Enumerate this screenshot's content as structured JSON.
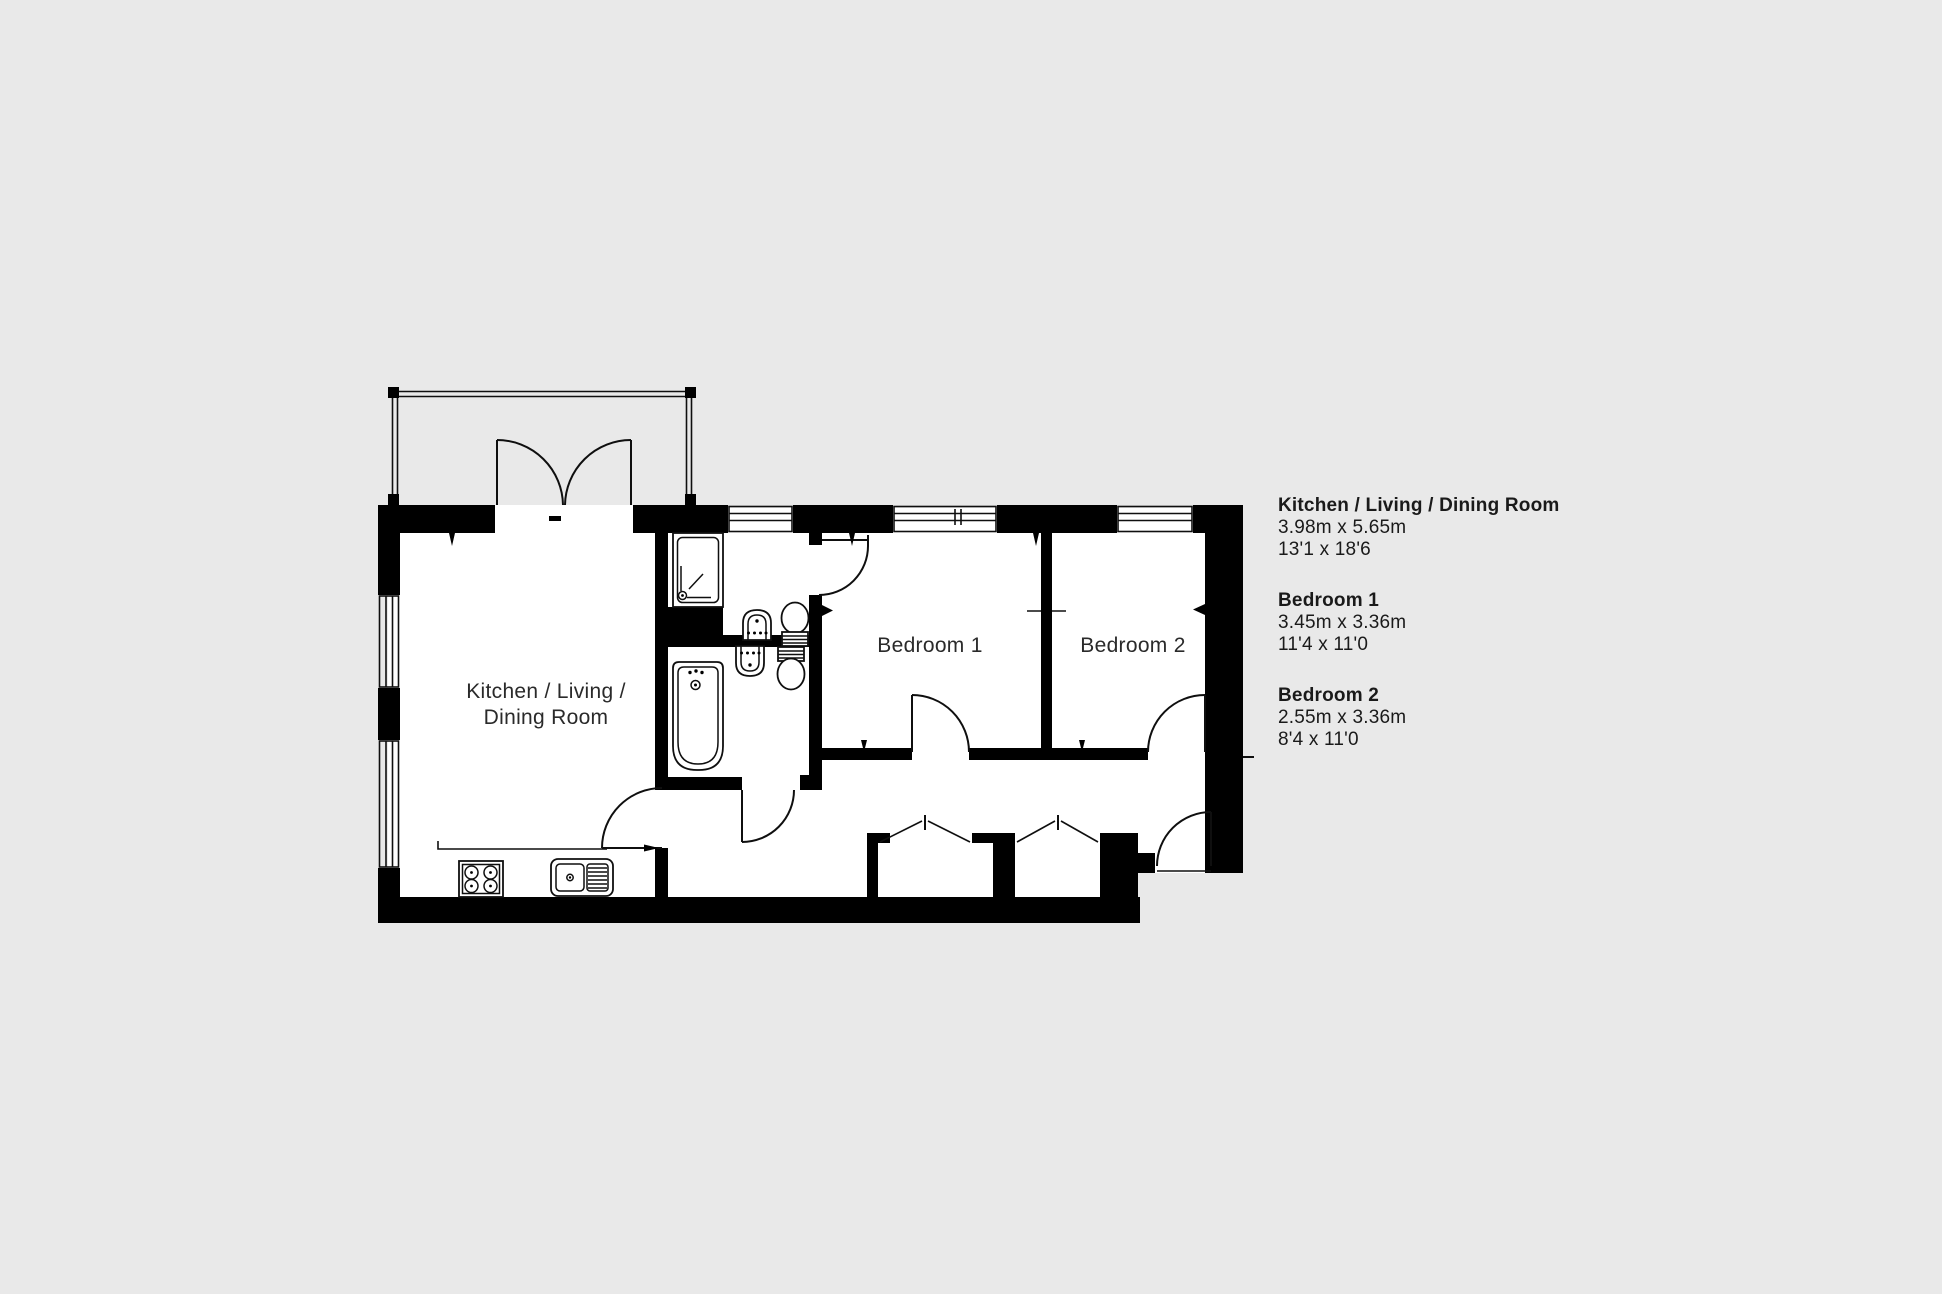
{
  "colors": {
    "background": "#e9e9e9",
    "walls": "#000000",
    "floor": "#ffffff",
    "lines": "#0f0f0f",
    "label_text": "#2a2a2a",
    "legend_text": "#1a1a1a"
  },
  "plan": {
    "room_labels": {
      "kitchen_line1": "Kitchen / Living /",
      "kitchen_line2": "Dining Room",
      "bedroom1": "Bedroom 1",
      "bedroom2": "Bedroom 2"
    },
    "fixture_names": [
      "balcony",
      "french-doors",
      "shower",
      "wash-basin",
      "toilet",
      "bathtub",
      "hob",
      "kitchen-sink",
      "wardrobe",
      "entrance-door"
    ]
  },
  "legend": {
    "entries": [
      {
        "name": "Kitchen / Living / Dining Room",
        "metric": "3.98m x 5.65m",
        "imperial": "13'1 x 18'6"
      },
      {
        "name": "Bedroom 1",
        "metric": "3.45m x 3.36m",
        "imperial": "11'4 x 11'0"
      },
      {
        "name": "Bedroom 2",
        "metric": "2.55m x 3.36m",
        "imperial": "8'4 x 11'0"
      }
    ]
  }
}
